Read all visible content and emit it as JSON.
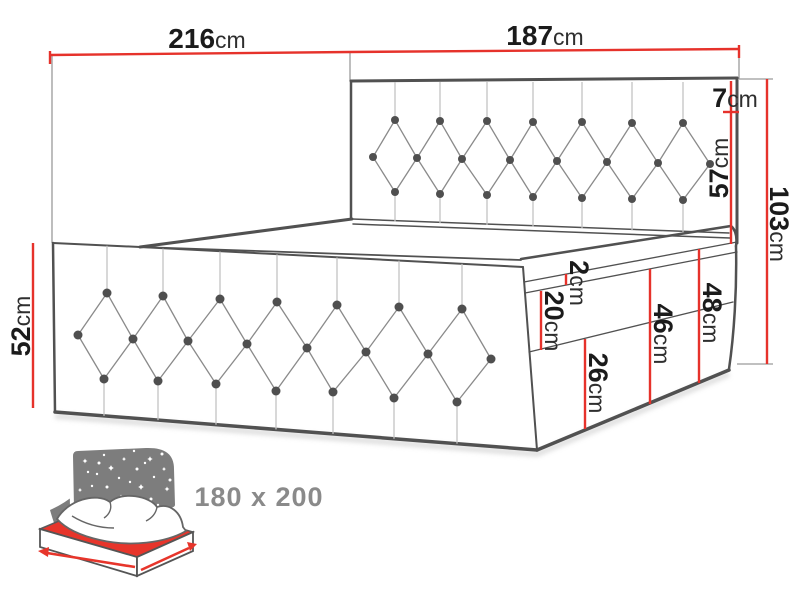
{
  "unit": "cm",
  "dimensions": {
    "total_length": "216",
    "headboard_width": "187",
    "headboard_border": "7",
    "headboard_inner": "57",
    "total_height": "103",
    "foot_end_height": "52",
    "mattress_gap": "2",
    "base_upper": "20",
    "base_lower": "26",
    "base_inner_height": "46",
    "base_outer_height": "48"
  },
  "icon": {
    "size_label": "180 x 200"
  },
  "colors": {
    "dimension_red": "#e6322b",
    "outline_gray": "#515151",
    "label_text": "#1b1b1b",
    "size_text": "#8a8a8a",
    "icon_gray": "#7d7d7d",
    "icon_red": "#e7352b"
  }
}
